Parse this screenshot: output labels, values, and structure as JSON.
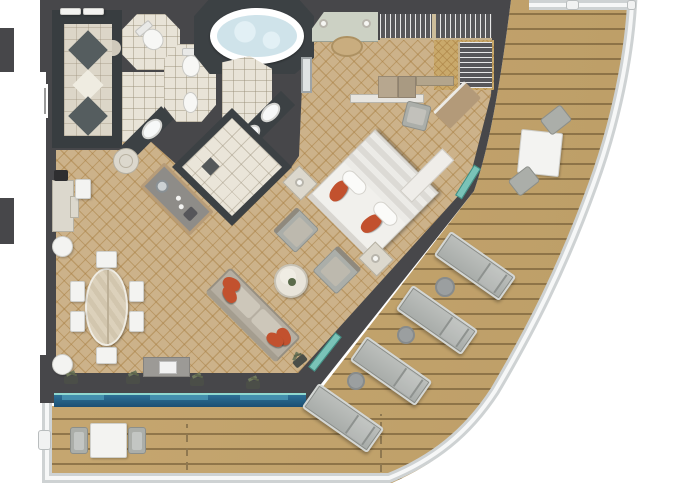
{
  "meta": {
    "title": "Suite floor plan with curved private veranda"
  },
  "palette": {
    "wall": "#47474a",
    "slate_floor": "#3c4144",
    "carpet": "#ccb28a",
    "carpet_lattice": "#a67c3e",
    "deck_wood": "#c2a46d",
    "deck_plank_line": "#654f2c",
    "bath_tile": "#e8e3d7",
    "marble": "#dcd8cd",
    "tub_water": "#cfe3ea",
    "accent_orange": "#c2512e",
    "window_glass_blue": "#22608a",
    "door_glass_teal": "#7ac3b8",
    "railing": "#ced2d3",
    "furniture_gray": "#abaea9",
    "furniture_white": "#f3f3f1",
    "wood_counter": "#b79c78"
  },
  "areas": [
    {
      "id": "entry-hall",
      "label": "Entry hall with marble diamond inlay floor"
    },
    {
      "id": "wc-left",
      "label": "WC (toilet room)"
    },
    {
      "id": "wc-right",
      "label": "WC with toilet and bidet"
    },
    {
      "id": "whirlpool-bath",
      "label": "Whirlpool bathtub"
    },
    {
      "id": "double-vanity",
      "label": "Vanity with two basins"
    },
    {
      "id": "shower-room",
      "label": "Walk-in shower room"
    },
    {
      "id": "walk-in-closet",
      "label": "Walk-in wardrobe with hanging rails"
    },
    {
      "id": "dressing-area",
      "label": "Dressing alcove with stool and lamps"
    },
    {
      "id": "bedroom",
      "label": "Bedroom with diagonal king bed"
    },
    {
      "id": "living-dining",
      "label": "Living and dining room"
    },
    {
      "id": "veranda",
      "label": "Curved teak veranda"
    }
  ],
  "furnishings": {
    "bed": "King bed with orange accent pillows, two nightstands with lamps, foot bench",
    "sofa": "Three-seat sofa with four orange pillows",
    "coffee_table": "Round marble cocktail table",
    "armchairs": 2,
    "dining_table": "Oval table with six chairs",
    "sideboard": "Marble console with espresso machine",
    "bar_counter": "Angled wet bar with sink",
    "tv_console": "Media cabinet with television",
    "desk": "Writing desk with chair and shelving",
    "deck_loungers": 4,
    "deck_side_tables": 3,
    "deck_dining_sets": 2,
    "window_plants": 5
  }
}
